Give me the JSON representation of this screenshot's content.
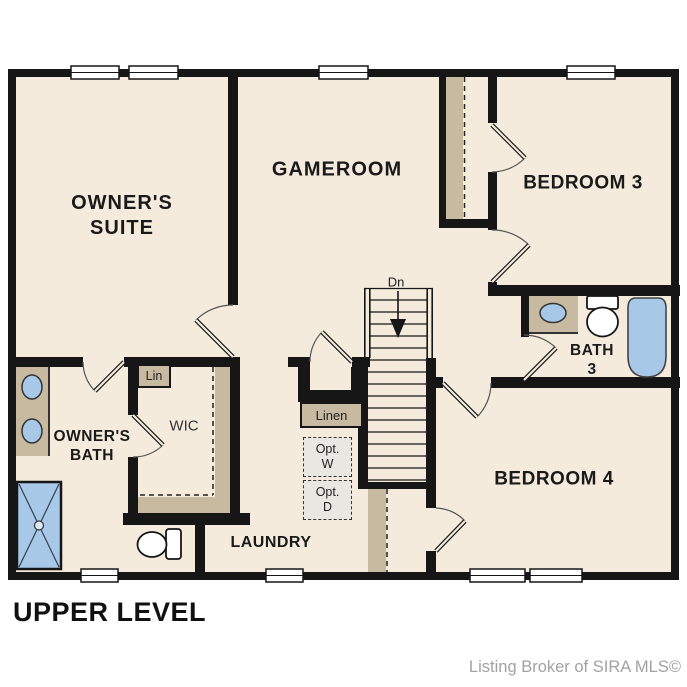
{
  "plan": {
    "title": "UPPER LEVEL",
    "watermark": "Listing Broker of SIRA MLS©",
    "rooms": {
      "owners_suite_line1": "OWNER'S",
      "owners_suite_line2": "SUITE",
      "gameroom": "GAMEROOM",
      "bedroom3": "BEDROOM 3",
      "bedroom4": "BEDROOM 4",
      "bath3_line1": "BATH",
      "bath3_line2": "3",
      "owners_bath_line1": "OWNER'S",
      "owners_bath_line2": "BATH",
      "wic": "WIC",
      "laundry": "LAUNDRY"
    },
    "closets": {
      "lin": "Lin",
      "linen": "Linen",
      "opt_washer_line1": "Opt.",
      "opt_washer_line2": "W",
      "opt_dryer_line1": "Opt.",
      "opt_dryer_line2": "D"
    },
    "stairs": {
      "direction_label": "Dn"
    },
    "colors": {
      "floor": "#f4ebdc",
      "wall": "#161616",
      "shelf_tan": "#c8baa0",
      "fixture_blue": "#a8c8e8",
      "optional_fill": "#e8e7e2",
      "watermark": "#a2a2a2"
    },
    "fixtures": {
      "owners_bath": [
        "double-vanity-sinks",
        "shower",
        "toilet"
      ],
      "bath3": [
        "vanity-sink",
        "toilet",
        "bathtub"
      ]
    }
  }
}
